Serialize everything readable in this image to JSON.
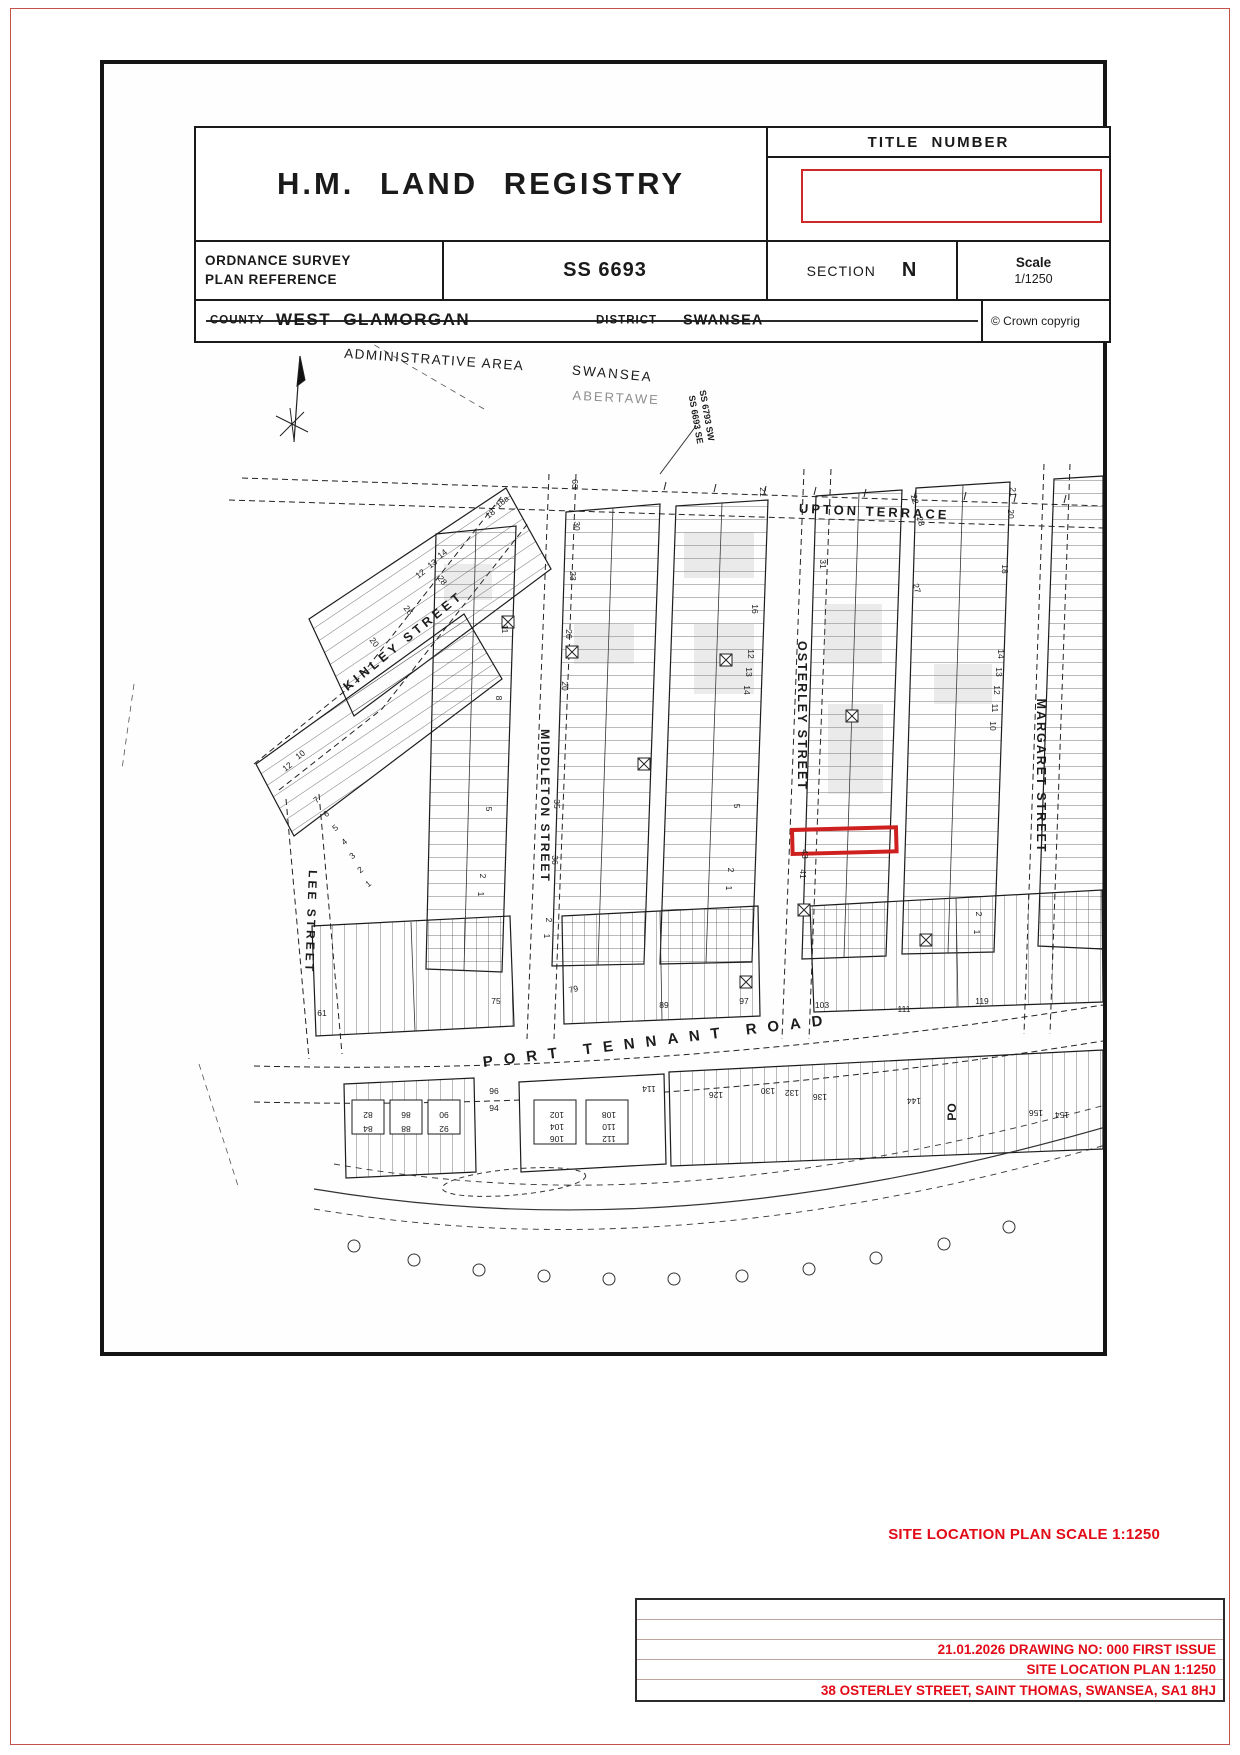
{
  "header": {
    "org_title": "H.M. LAND REGISTRY",
    "title_number_label": "TITLE NUMBER",
    "os_ref_label_line1": "ORDNANCE SURVEY",
    "os_ref_label_line2": "PLAN REFERENCE",
    "os_ref_value": "SS 6693",
    "section_label": "SECTION",
    "section_value": "N",
    "scale_label": "Scale",
    "scale_value": "1/1250",
    "county_label": "COUNTY",
    "county_value": "WEST GLAMORGAN",
    "district_label": "DISTRICT",
    "district_value": "SWANSEA",
    "copyright": "©   Crown copyrig"
  },
  "map": {
    "highlight_color": "#cf2020",
    "port_tennant_label": "PORT TENNANT ROAD",
    "streets": [
      "UPTON TERRACE",
      "KINLEY STREET",
      "LEE STREET",
      "MIDDLETON STREET",
      "OSTERLEY STREET",
      "MARGARET STREET",
      "PORT TENNANT ROAD"
    ],
    "labels": [
      {
        "t": "ADMINISTRATIVE AREA",
        "x": 330,
        "y": 300,
        "r": 4,
        "s": 13.5,
        "sp": 1.5
      },
      {
        "t": "SWANSEA",
        "x": 508,
        "y": 314,
        "r": 5,
        "s": 13.5,
        "sp": 2
      },
      {
        "t": "ABERTAWE",
        "x": 512,
        "y": 338,
        "r": 3,
        "s": 13,
        "sp": 2,
        "o": 0.5
      },
      {
        "t": "SS 6793 SW",
        "x": 600,
        "y": 352,
        "r": 80,
        "s": 9,
        "b": 1
      },
      {
        "t": "SS 6693 SE",
        "x": 589,
        "y": 356,
        "r": 80,
        "s": 9,
        "b": 1
      },
      {
        "t": "UPTON TERRACE",
        "x": 770,
        "y": 452,
        "r": 2.5,
        "s": 13,
        "sp": 3,
        "b": 1
      },
      {
        "t": "KINLEY STREET",
        "x": 302,
        "y": 580,
        "r": -39,
        "s": 12.5,
        "sp": 4,
        "b": 1
      },
      {
        "t": "LEE STREET",
        "x": 203,
        "y": 858,
        "r": 92,
        "s": 12,
        "sp": 3,
        "b": 1
      },
      {
        "t": "MIDDLETON STREET",
        "x": 437,
        "y": 742,
        "r": 90,
        "s": 12,
        "sp": 2,
        "b": 1
      },
      {
        "t": "OSTERLEY STREET",
        "x": 694,
        "y": 652,
        "r": 90,
        "s": 12.5,
        "sp": 2,
        "b": 1
      },
      {
        "t": "MARGARET STREET",
        "x": 933,
        "y": 712,
        "r": 90,
        "s": 12.5,
        "sp": 2,
        "b": 1
      },
      {
        "t": "18a",
        "x": 400,
        "y": 440,
        "r": -38
      },
      {
        "t": "18",
        "x": 388,
        "y": 452,
        "r": -38
      },
      {
        "t": "14",
        "x": 340,
        "y": 492,
        "r": -38
      },
      {
        "t": "13",
        "x": 330,
        "y": 502,
        "r": -38
      },
      {
        "t": "12",
        "x": 318,
        "y": 512,
        "r": -38
      },
      {
        "t": "28",
        "x": 336,
        "y": 518,
        "r": 52
      },
      {
        "t": "26",
        "x": 302,
        "y": 548,
        "r": 52
      },
      {
        "t": "20",
        "x": 268,
        "y": 580,
        "r": 52
      },
      {
        "t": "12",
        "x": 185,
        "y": 705,
        "r": -38
      },
      {
        "t": "10",
        "x": 198,
        "y": 693,
        "r": -38
      },
      {
        "t": "7",
        "x": 214,
        "y": 738,
        "r": -38
      },
      {
        "t": "6",
        "x": 224,
        "y": 752,
        "r": -38
      },
      {
        "t": "5",
        "x": 233,
        "y": 766,
        "r": -38
      },
      {
        "t": "4",
        "x": 242,
        "y": 780,
        "r": -38
      },
      {
        "t": "3",
        "x": 250,
        "y": 794,
        "r": -38
      },
      {
        "t": "2",
        "x": 258,
        "y": 808,
        "r": -38
      },
      {
        "t": "1",
        "x": 266,
        "y": 822,
        "r": -38
      },
      {
        "t": "11",
        "x": 398,
        "y": 565,
        "r": 90
      },
      {
        "t": "8",
        "x": 392,
        "y": 634,
        "r": 90
      },
      {
        "t": "5",
        "x": 382,
        "y": 745,
        "r": 90
      },
      {
        "t": "2",
        "x": 376,
        "y": 812,
        "r": 90
      },
      {
        "t": "1",
        "x": 374,
        "y": 830,
        "r": 90
      },
      {
        "t": "63",
        "x": 468,
        "y": 420,
        "r": 90
      },
      {
        "t": "30",
        "x": 470,
        "y": 462,
        "r": 90
      },
      {
        "t": "23",
        "x": 466,
        "y": 512,
        "r": 90
      },
      {
        "t": "26",
        "x": 462,
        "y": 570,
        "r": 90
      },
      {
        "t": "20",
        "x": 458,
        "y": 622,
        "r": 90
      },
      {
        "t": "35",
        "x": 450,
        "y": 740,
        "r": 90
      },
      {
        "t": "36",
        "x": 448,
        "y": 796,
        "r": 90
      },
      {
        "t": "2",
        "x": 442,
        "y": 856,
        "r": 90
      },
      {
        "t": "1",
        "x": 440,
        "y": 872,
        "r": 90
      },
      {
        "t": "21",
        "x": 656,
        "y": 428,
        "r": 90
      },
      {
        "t": "16",
        "x": 648,
        "y": 545,
        "r": 90
      },
      {
        "t": "12",
        "x": 644,
        "y": 590,
        "r": 90
      },
      {
        "t": "13",
        "x": 642,
        "y": 608,
        "r": 90
      },
      {
        "t": "14",
        "x": 640,
        "y": 626,
        "r": 90
      },
      {
        "t": "5",
        "x": 630,
        "y": 742,
        "r": 90
      },
      {
        "t": "2",
        "x": 624,
        "y": 806,
        "r": 90
      },
      {
        "t": "1",
        "x": 622,
        "y": 824,
        "r": 90
      },
      {
        "t": "31",
        "x": 716,
        "y": 500,
        "r": 90
      },
      {
        "t": "43",
        "x": 698,
        "y": 790,
        "r": 90
      },
      {
        "t": "41",
        "x": 696,
        "y": 810,
        "r": 90
      },
      {
        "t": "22",
        "x": 808,
        "y": 436,
        "r": 75
      },
      {
        "t": "23",
        "x": 814,
        "y": 458,
        "r": 75
      },
      {
        "t": "27",
        "x": 810,
        "y": 525,
        "r": 75
      },
      {
        "t": "21",
        "x": 906,
        "y": 428,
        "r": 90
      },
      {
        "t": "20",
        "x": 904,
        "y": 450,
        "r": 90
      },
      {
        "t": "18",
        "x": 898,
        "y": 505,
        "r": 90
      },
      {
        "t": "14",
        "x": 894,
        "y": 590,
        "r": 90
      },
      {
        "t": "13",
        "x": 892,
        "y": 608,
        "r": 90
      },
      {
        "t": "12",
        "x": 890,
        "y": 626,
        "r": 90
      },
      {
        "t": "11",
        "x": 888,
        "y": 644,
        "r": 90
      },
      {
        "t": "10",
        "x": 886,
        "y": 662,
        "r": 90
      },
      {
        "t": "2",
        "x": 872,
        "y": 850,
        "r": 90
      },
      {
        "t": "1",
        "x": 870,
        "y": 868,
        "r": 90
      },
      {
        "t": "61",
        "x": 218,
        "y": 952,
        "r": 0
      },
      {
        "t": "75",
        "x": 392,
        "y": 940,
        "r": 0
      },
      {
        "t": "79",
        "x": 470,
        "y": 928,
        "r": -12
      },
      {
        "t": "89",
        "x": 560,
        "y": 944,
        "r": 0
      },
      {
        "t": "97",
        "x": 640,
        "y": 940,
        "r": 0
      },
      {
        "t": "103",
        "x": 718,
        "y": 944,
        "r": 0
      },
      {
        "t": "111",
        "x": 800,
        "y": 948,
        "r": 0
      },
      {
        "t": "119",
        "x": 878,
        "y": 940,
        "r": 0
      },
      {
        "t": "82",
        "x": 264,
        "y": 1048,
        "r": 180
      },
      {
        "t": "84",
        "x": 264,
        "y": 1062,
        "r": 180
      },
      {
        "t": "86",
        "x": 302,
        "y": 1048,
        "r": 180
      },
      {
        "t": "88",
        "x": 302,
        "y": 1062,
        "r": 180
      },
      {
        "t": "90",
        "x": 340,
        "y": 1048,
        "r": 180
      },
      {
        "t": "92",
        "x": 340,
        "y": 1062,
        "r": 180
      },
      {
        "t": "96",
        "x": 390,
        "y": 1030,
        "r": 0
      },
      {
        "t": "94",
        "x": 390,
        "y": 1047,
        "r": 0
      },
      {
        "t": "102",
        "x": 453,
        "y": 1048,
        "r": 180
      },
      {
        "t": "104",
        "x": 453,
        "y": 1060,
        "r": 180
      },
      {
        "t": "106",
        "x": 453,
        "y": 1072,
        "r": 180
      },
      {
        "t": "108",
        "x": 505,
        "y": 1048,
        "r": 180
      },
      {
        "t": "110",
        "x": 505,
        "y": 1060,
        "r": 180
      },
      {
        "t": "112",
        "x": 505,
        "y": 1072,
        "r": 180
      },
      {
        "t": "114",
        "x": 545,
        "y": 1022,
        "r": 180
      },
      {
        "t": "126",
        "x": 612,
        "y": 1028,
        "r": 180
      },
      {
        "t": "130",
        "x": 664,
        "y": 1024,
        "r": 180
      },
      {
        "t": "132",
        "x": 688,
        "y": 1026,
        "r": 180
      },
      {
        "t": "136",
        "x": 716,
        "y": 1030,
        "r": 180
      },
      {
        "t": "144",
        "x": 810,
        "y": 1034,
        "r": 180
      },
      {
        "t": "PO",
        "x": 852,
        "y": 1048,
        "r": -90,
        "s": 12,
        "b": 1
      },
      {
        "t": "156",
        "x": 932,
        "y": 1046,
        "r": 180
      },
      {
        "t": "154",
        "x": 958,
        "y": 1048,
        "r": 180
      }
    ]
  },
  "annotations": {
    "text_color": "#e30b17",
    "site_plan_scale": "SITE LOCATION PLAN SCALE 1:1250",
    "title_block_lines": [
      "21.01.2026 DRAWING NO: 000 FIRST ISSUE",
      "SITE LOCATION PLAN 1:1250",
      "38 OSTERLEY STREET, SAINT THOMAS, SWANSEA, SA1 8HJ"
    ]
  }
}
